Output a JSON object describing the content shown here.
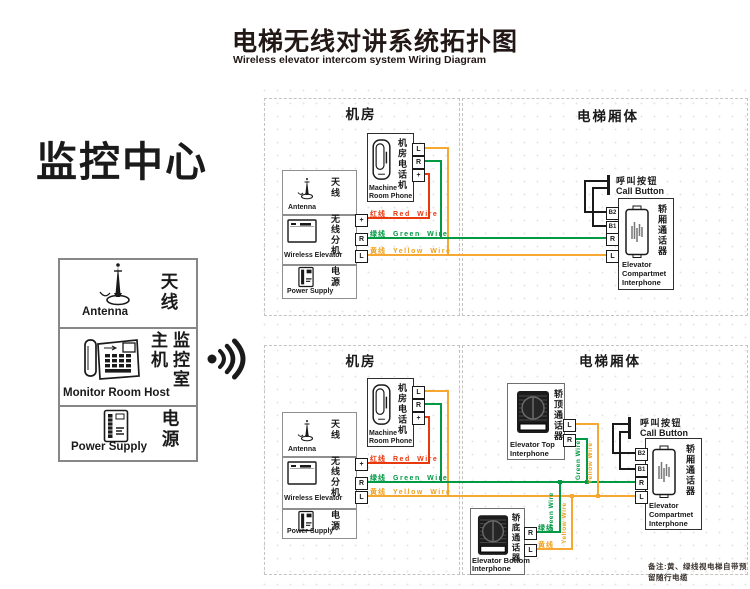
{
  "title": {
    "zh": "电梯无线对讲系统拓扑图",
    "en": "Wireless elevator intercom system Wiring Diagram"
  },
  "monitor_center": {
    "heading": "监控中心",
    "antenna": {
      "zh": "天线",
      "en": "Antenna"
    },
    "host": {
      "zh": "监控室主机",
      "en": "Monitor Room Host"
    },
    "power": {
      "zh": "电源",
      "en": "Power Supply"
    }
  },
  "sections": {
    "machine_room": "机房",
    "elevator_car": "电梯厢体"
  },
  "machine_room_phone": {
    "zh": "机房电话机",
    "en_line1": "Machine",
    "en_line2": "Room Phone",
    "terminals": [
      "L",
      "R",
      "+"
    ]
  },
  "station": {
    "antenna": {
      "zh": "天线",
      "en": "Antenna"
    },
    "wireless": {
      "zh": "无线分机",
      "en": "Wireless Elevator",
      "terminals": [
        "+",
        "R",
        "L"
      ]
    },
    "power": {
      "zh": "电源",
      "en": "Power Supply"
    }
  },
  "call_button": {
    "zh": "呼叫按钮",
    "en": "Call Button"
  },
  "compartment_interphone": {
    "zh": "轿厢通话器",
    "en_line1": "Elevator",
    "en_line2": "Compartmet",
    "en_line3": "Interphone",
    "terminals": [
      "B2",
      "B1",
      "R",
      "L"
    ]
  },
  "top_interphone": {
    "zh": "轿顶通话器",
    "en_line1": "Elevator Top",
    "en_line2": "Interphone",
    "terminals": [
      "L",
      "R"
    ]
  },
  "bottom_interphone": {
    "zh": "轿底通话器",
    "en_line1": "Elevator Bottom",
    "en_line2": "Interphone",
    "terminals": [
      "R",
      "L"
    ],
    "green_zh": "绿线",
    "yellow_zh": "黄线"
  },
  "wires": {
    "red": {
      "zh": "红线",
      "en": "Red Wire",
      "color": "#e8380d"
    },
    "green": {
      "zh": "绿线",
      "en": "Green Wire",
      "color": "#009944"
    },
    "yellow": {
      "zh": "黄线",
      "en": "Yellow Wire",
      "color": "#f7a832"
    }
  },
  "note": "备注:黄、绿线视电梯自带预留随行电缆"
}
